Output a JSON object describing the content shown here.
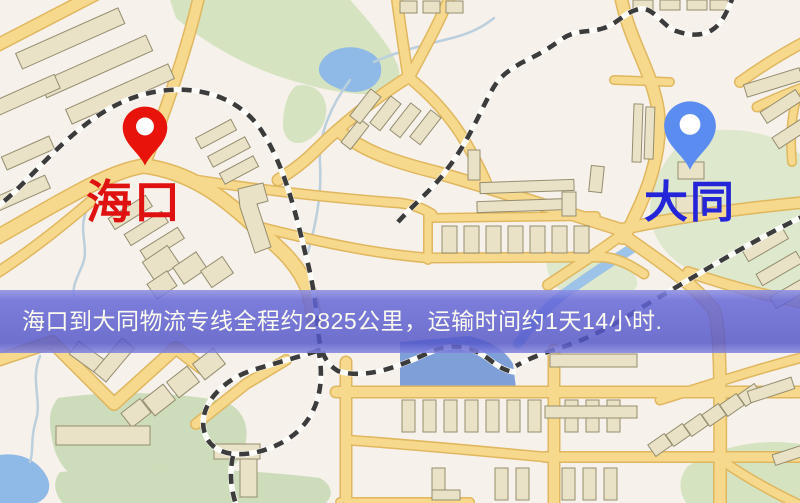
{
  "markers": {
    "origin": {
      "label": "海口",
      "pin_color": "#e8140c",
      "label_color": "#e01111",
      "icon": "location-pin-icon"
    },
    "destination": {
      "label": "大同",
      "pin_color": "#5b8cf0",
      "label_color": "#2424d8",
      "icon": "location-pin-icon"
    }
  },
  "banner": {
    "text": "海口到大同物流专线全程约2825公里，运输时间约1天14小时.",
    "distance": "约2825公里",
    "duration": "约1天14小时",
    "background": "rgba(88,90,214,0.82)",
    "text_color": "#fcfbef"
  },
  "map_colors": {
    "background": "#f6f1ea",
    "road": "#f6d98c",
    "road_casing": "#e0b75f",
    "building": "#eae2c7",
    "building_outline": "#958d6f",
    "park": "#d5e3c1",
    "water": "#8fb9e6",
    "railway": "#3c3c3c"
  }
}
